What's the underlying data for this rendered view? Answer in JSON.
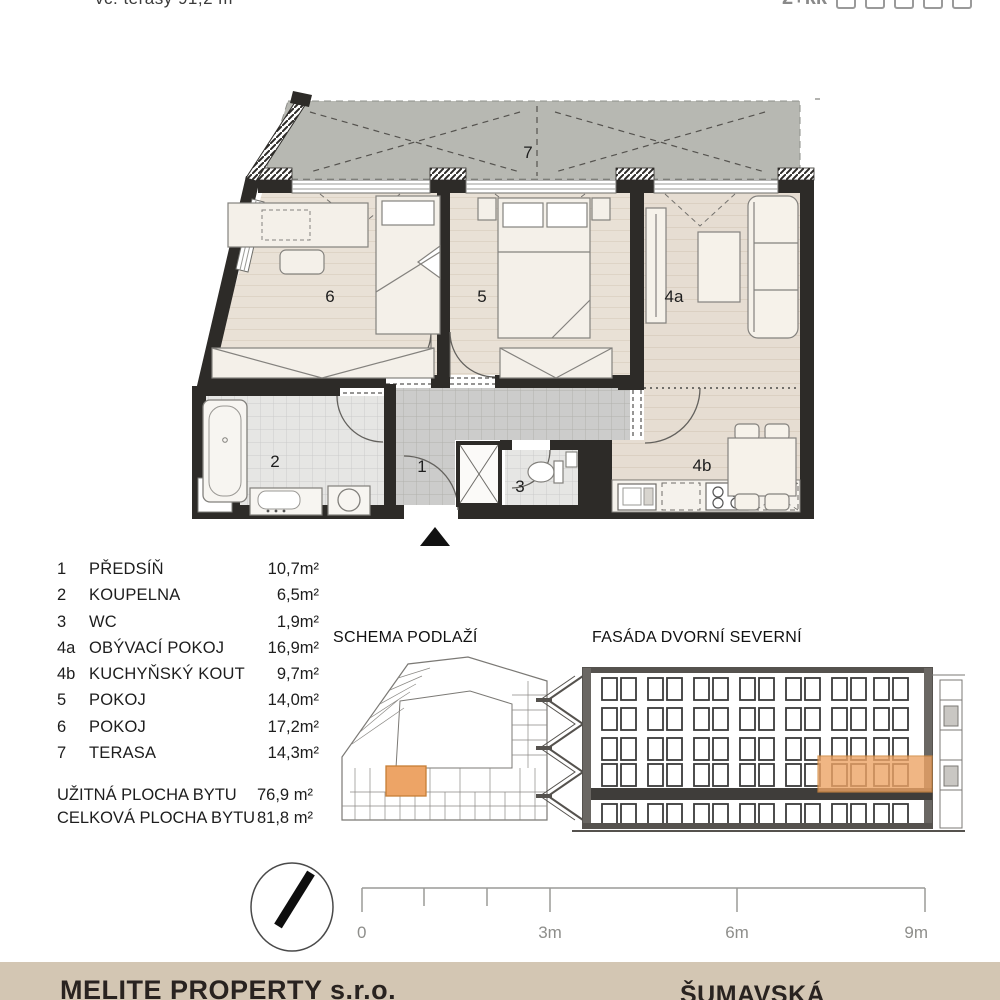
{
  "header": {
    "area_note_clipped": "vč. terasy 91,2 m²",
    "layout_clipped": "2+kk"
  },
  "plan": {
    "room_labels": {
      "hall": "1",
      "bath": "2",
      "wc": "3",
      "living": "4a",
      "kitchen": "4b",
      "bedroom1": "5",
      "bedroom2": "6",
      "terrace": "7"
    }
  },
  "legend": {
    "rows": [
      {
        "num": "1",
        "name": "PŘEDSÍŇ",
        "area": "10,7m²"
      },
      {
        "num": "2",
        "name": "KOUPELNA",
        "area": "6,5m²"
      },
      {
        "num": "3",
        "name": "WC",
        "area": "1,9m²"
      },
      {
        "num": "4a",
        "name": "OBÝVACÍ POKOJ",
        "area": "16,9m²"
      },
      {
        "num": "4b",
        "name": "KUCHYŇSKÝ KOUT",
        "area": "9,7m²"
      },
      {
        "num": "5",
        "name": "POKOJ",
        "area": "14,0m²"
      },
      {
        "num": "6",
        "name": "POKOJ",
        "area": "17,2m²"
      },
      {
        "num": "7",
        "name": "TERASA",
        "area": "14,3m²"
      }
    ],
    "totals": [
      {
        "label": "UŽITNÁ PLOCHA BYTU",
        "value": "76,9 m²"
      },
      {
        "label": "CELKOVÁ PLOCHA BYTU",
        "value": "81,8 m²"
      }
    ]
  },
  "sections": {
    "schema_title": "SCHEMA PODLAŽÍ",
    "facade_title": "FASÁDA DVORNÍ SEVERNÍ"
  },
  "scalebar": {
    "labels": [
      "0",
      "3m",
      "6m",
      "9m"
    ]
  },
  "footer": {
    "company": "MELITE PROPERTY s.r.o.",
    "street": "ŠUMAVSKÁ"
  },
  "colors": {
    "wall": "#2d2b28",
    "floor": "#e8e0d5",
    "terrace": "#b7b8b2",
    "tiles_hall": "#cbcbc7",
    "tiles_bath": "#e3e3e1",
    "highlight": "#eda466",
    "band": "#d3c6b3"
  }
}
